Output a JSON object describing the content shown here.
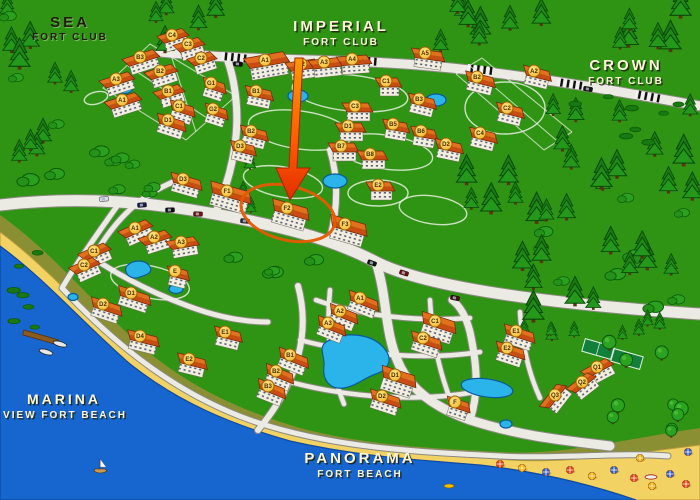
{
  "map_title": "Fort Club resort map",
  "areas": [
    {
      "id": "sea-fort-club",
      "line1": "SEA",
      "line2": "FORT CLUB"
    },
    {
      "id": "imperial-fort-club",
      "line1": "IMPERIAL",
      "line2": "FORT CLUB"
    },
    {
      "id": "crown-fort-club",
      "line1": "CROWN",
      "line2": "FORT CLUB"
    },
    {
      "id": "marina-view-fort-beach",
      "line1": "MARINA",
      "line2": "VIEW FORT BEACH"
    },
    {
      "id": "panorama-fort-beach",
      "line1": "PANORAMA",
      "line2": "FORT BEACH"
    }
  ],
  "highlight": {
    "highlighted_building": "F2",
    "marker": "large orange arrow pointing down at building F2, circled with an orange ellipse"
  },
  "buildings_format": [
    "cluster",
    "label",
    "x",
    "y",
    "angle",
    "width"
  ],
  "buildings": [
    [
      "sea",
      "C4",
      172,
      35,
      -18,
      26
    ],
    [
      "sea",
      "C3",
      188,
      44,
      -18,
      26
    ],
    [
      "sea",
      "C2",
      201,
      58,
      -18,
      24
    ],
    [
      "sea",
      "B3",
      140,
      57,
      -18,
      32
    ],
    [
      "sea",
      "B2",
      160,
      71,
      -18,
      28
    ],
    [
      "sea",
      "B1",
      168,
      91,
      -18,
      26
    ],
    [
      "sea",
      "A3",
      116,
      79,
      -18,
      30
    ],
    [
      "sea",
      "A1",
      122,
      100,
      -18,
      32
    ],
    [
      "sea",
      "G1",
      211,
      83,
      18,
      22
    ],
    [
      "sea",
      "G2",
      213,
      109,
      18,
      22
    ],
    [
      "sea",
      "C1",
      179,
      106,
      18,
      24
    ],
    [
      "sea",
      "D1",
      168,
      120,
      18,
      28
    ],
    [
      "imperial",
      "A1",
      265,
      60,
      -10,
      40
    ],
    [
      "imperial",
      "A2",
      301,
      64,
      -8,
      30
    ],
    [
      "imperial",
      "A3",
      324,
      62,
      -6,
      30
    ],
    [
      "imperial",
      "A4",
      352,
      59,
      -4,
      30
    ],
    [
      "imperial",
      "A5",
      425,
      53,
      8,
      30
    ],
    [
      "imperial",
      "B1",
      256,
      91,
      12,
      26
    ],
    [
      "imperial",
      "B2",
      251,
      131,
      14,
      26
    ],
    [
      "imperial",
      "B3",
      419,
      99,
      14,
      26
    ],
    [
      "imperial",
      "C1",
      386,
      81,
      0,
      22
    ],
    [
      "imperial",
      "C3",
      355,
      106,
      0,
      26
    ],
    [
      "imperial",
      "D1",
      348,
      126,
      0,
      26
    ],
    [
      "imperial",
      "B5",
      393,
      124,
      10,
      24
    ],
    [
      "imperial",
      "B6",
      421,
      131,
      10,
      24
    ],
    [
      "imperial",
      "B7",
      341,
      146,
      0,
      26
    ],
    [
      "imperial",
      "B8",
      370,
      154,
      0,
      26
    ],
    [
      "imperial",
      "D2",
      446,
      144,
      12,
      26
    ],
    [
      "imperial",
      "D3",
      240,
      146,
      14,
      24
    ],
    [
      "imperial",
      "E2",
      378,
      185,
      0,
      24
    ],
    [
      "imperial",
      "F1",
      227,
      191,
      16,
      40
    ],
    [
      "imperial",
      "F2",
      287,
      208,
      16,
      36
    ],
    [
      "imperial",
      "F3",
      345,
      224,
      16,
      36
    ],
    [
      "crown",
      "A2",
      534,
      71,
      14,
      26
    ],
    [
      "crown",
      "B2",
      477,
      77,
      14,
      28
    ],
    [
      "crown",
      "C2",
      507,
      108,
      14,
      26
    ],
    [
      "crown",
      "C4",
      480,
      133,
      14,
      26
    ],
    [
      "marina",
      "D3",
      183,
      179,
      16,
      30
    ],
    [
      "marina",
      "A1",
      135,
      228,
      -24,
      30
    ],
    [
      "marina",
      "A2",
      154,
      237,
      -18,
      28
    ],
    [
      "marina",
      "A3",
      181,
      242,
      -10,
      28
    ],
    [
      "marina",
      "C1",
      94,
      251,
      -24,
      28
    ],
    [
      "marina",
      "C2",
      84,
      265,
      -24,
      26
    ],
    [
      "marina",
      "E",
      175,
      271,
      14,
      20
    ],
    [
      "marina",
      "D1",
      131,
      293,
      18,
      32
    ],
    [
      "marina",
      "D2",
      103,
      304,
      18,
      30
    ],
    [
      "marina",
      "D4",
      140,
      336,
      14,
      30
    ],
    [
      "marina",
      "E1",
      225,
      332,
      14,
      26
    ],
    [
      "marina",
      "E2",
      189,
      359,
      14,
      28
    ],
    [
      "panorama",
      "A1",
      360,
      298,
      22,
      30
    ],
    [
      "panorama",
      "A2",
      340,
      311,
      22,
      28
    ],
    [
      "panorama",
      "A3",
      328,
      323,
      22,
      28
    ],
    [
      "panorama",
      "B1",
      290,
      355,
      22,
      30
    ],
    [
      "panorama",
      "B2",
      276,
      371,
      22,
      28
    ],
    [
      "panorama",
      "B3",
      268,
      386,
      22,
      28
    ],
    [
      "panorama",
      "C1",
      435,
      321,
      18,
      34
    ],
    [
      "panorama",
      "C2",
      423,
      338,
      18,
      30
    ],
    [
      "panorama",
      "D1",
      395,
      375,
      18,
      34
    ],
    [
      "panorama",
      "D2",
      382,
      396,
      18,
      30
    ],
    [
      "panorama",
      "E1",
      516,
      331,
      18,
      30
    ],
    [
      "panorama",
      "E2",
      507,
      348,
      18,
      28
    ],
    [
      "panorama",
      "F",
      455,
      402,
      18,
      22
    ],
    [
      "panorama",
      "Q1",
      597,
      367,
      -28,
      28
    ],
    [
      "panorama",
      "Q2",
      582,
      382,
      -38,
      26
    ],
    [
      "panorama",
      "Q3",
      555,
      395,
      -52,
      28
    ]
  ],
  "pools": [
    {
      "type": "ellipse",
      "x": 124,
      "y": 88,
      "rx": 9,
      "ry": 5.5
    },
    {
      "type": "ellipse",
      "x": 298,
      "y": 96,
      "rx": 10,
      "ry": 6
    },
    {
      "type": "ellipse",
      "x": 436,
      "y": 100,
      "rx": 10,
      "ry": 6
    },
    {
      "type": "ellipse",
      "x": 335,
      "y": 181,
      "rx": 12,
      "ry": 7
    },
    {
      "type": "kidney",
      "x": 138,
      "y": 271
    },
    {
      "type": "ellipse",
      "x": 73,
      "y": 297,
      "rx": 5,
      "ry": 3.5
    },
    {
      "type": "ellipse",
      "x": 176,
      "y": 289,
      "rx": 7,
      "ry": 4.5
    },
    {
      "type": "lagoon",
      "x": 358,
      "y": 364
    },
    {
      "type": "ellipse",
      "x": 487,
      "y": 388,
      "rx": 26,
      "ry": 9,
      "rot": 8
    },
    {
      "type": "ellipse",
      "x": 506,
      "y": 424,
      "rx": 6,
      "ry": 4
    }
  ],
  "tennis_courts": [
    {
      "x": 598,
      "y": 349,
      "rot": 16
    },
    {
      "x": 627,
      "y": 359,
      "rot": 16
    }
  ],
  "umbrellas": [
    [
      500,
      464
    ],
    [
      522,
      468
    ],
    [
      546,
      472
    ],
    [
      570,
      470
    ],
    [
      592,
      476
    ],
    [
      614,
      470
    ],
    [
      634,
      478
    ],
    [
      652,
      486
    ],
    [
      670,
      474
    ],
    [
      686,
      484
    ],
    [
      640,
      458
    ],
    [
      688,
      452
    ]
  ],
  "boats": {
    "pier": {
      "x": 24,
      "y": 330,
      "rot": 16
    },
    "moored": [
      [
        46,
        352
      ],
      [
        60,
        344
      ]
    ],
    "sailboat": [
      100,
      468
    ],
    "motorboat": [
      651,
      477
    ],
    "pedalboat": [
      449,
      486
    ]
  },
  "cars": [
    [
      142,
      205,
      -4,
      "#191d45"
    ],
    [
      170,
      210,
      -2,
      "#101010"
    ],
    [
      198,
      214,
      2,
      "#751111"
    ],
    [
      245,
      221,
      5,
      "#23273f"
    ],
    [
      372,
      263,
      20,
      "#131313"
    ],
    [
      404,
      273,
      18,
      "#6e1010"
    ],
    [
      238,
      64,
      4,
      "#101010"
    ],
    [
      588,
      89,
      9,
      "#131313"
    ],
    [
      104,
      199,
      -4,
      "#d8dbe8"
    ],
    [
      455,
      298,
      12,
      "#401010"
    ]
  ],
  "tree_regions": [
    [
      4,
      4,
      90,
      195,
      15,
      "mixed"
    ],
    [
      96,
      142,
      66,
      84,
      7,
      "bush"
    ],
    [
      150,
      2,
      84,
      40,
      5,
      "pine"
    ],
    [
      398,
      2,
      150,
      44,
      8,
      "pine"
    ],
    [
      600,
      2,
      96,
      50,
      6,
      "pine"
    ],
    [
      548,
      100,
      146,
      88,
      13,
      "pine"
    ],
    [
      462,
      158,
      110,
      70,
      7,
      "pine"
    ],
    [
      488,
      196,
      200,
      118,
      22,
      "mixed"
    ],
    [
      430,
      318,
      256,
      20,
      9,
      "pine_s"
    ],
    [
      604,
      330,
      92,
      104,
      10,
      "round"
    ],
    [
      214,
      252,
      110,
      36,
      4,
      "bush"
    ],
    [
      238,
      158,
      36,
      62,
      3,
      "pine_s"
    ],
    [
      556,
      96,
      132,
      56,
      8,
      "tuft"
    ],
    [
      8,
      246,
      52,
      86,
      7,
      "tuft"
    ]
  ],
  "colors": {
    "grass": "#2f9414",
    "sea": "#1766cf",
    "sand": "#f1d263",
    "dune": "#8a8f33",
    "road": "#ebebe4",
    "road_edge": "#8a8a80",
    "roof": "#c94c12",
    "roof_light": "#e2701c",
    "facade": "#f3efe0",
    "badge": "#ffd23e",
    "badge_text": "#4a2a00",
    "arrow": "#ff6a00",
    "highlight_ring": "#e85800",
    "pine": "#1f8a16",
    "pool": "#2ab4ea",
    "label_light": "#fdf7da",
    "label_dark": "#241a08"
  }
}
